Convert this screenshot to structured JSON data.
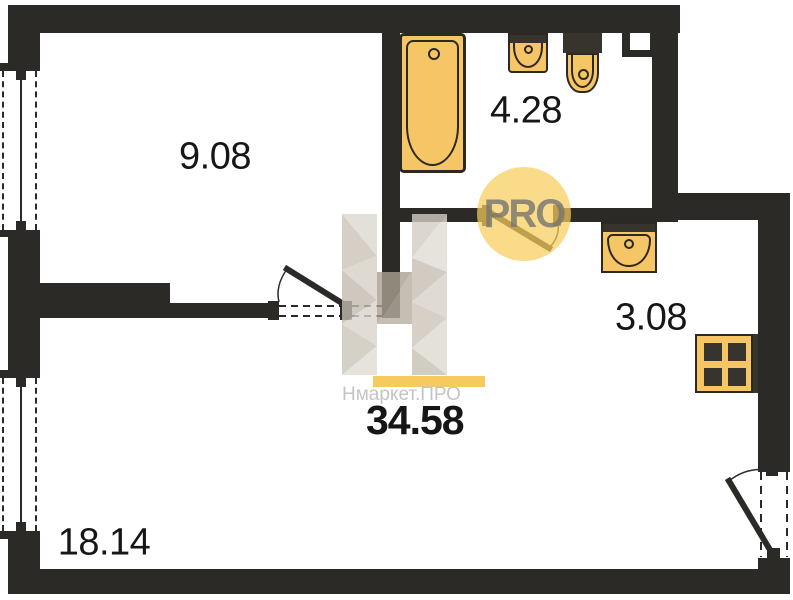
{
  "plan": {
    "rooms": [
      {
        "name": "room",
        "area": "9.08"
      },
      {
        "name": "bathroom",
        "area": "4.28"
      },
      {
        "name": "kitchen",
        "area": "3.08"
      },
      {
        "name": "living-room",
        "area": "18.14"
      }
    ],
    "total_area": "34.58"
  },
  "watermark": {
    "brand": "Нмаркет.ПРО",
    "badge": "PRO"
  },
  "fixtures": [
    "bathtub",
    "sink",
    "toilet",
    "kitchen-sink",
    "stove"
  ],
  "colors": {
    "wall": "#2b2a27",
    "dark_accent": "#37332d",
    "fixture": "#f6c666",
    "fixture_border": "#2c2822",
    "badge_circle": "rgba(246,205,92,0.72)",
    "badge_text": "rgba(118,116,110,0.8)",
    "accent_bar": "#f7ca5f",
    "brand_text": "#c4c4c4",
    "label_text": "#161616"
  }
}
